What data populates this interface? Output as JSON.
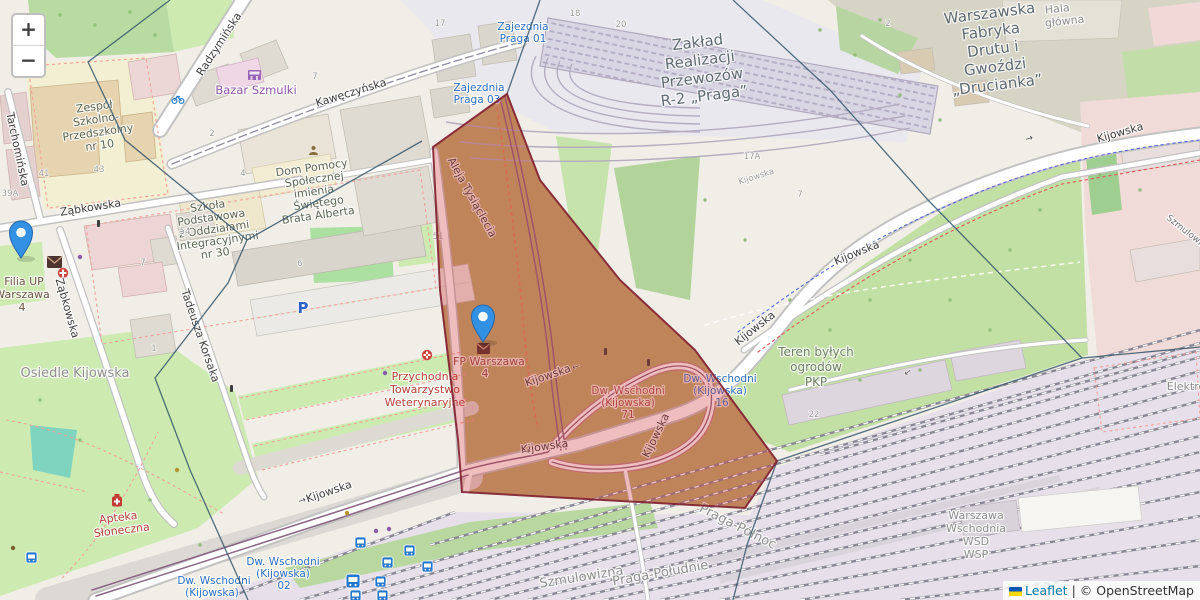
{
  "controls": {
    "zoom_in": "+",
    "zoom_out": "−"
  },
  "attribution": {
    "leaflet": "Leaflet",
    "sep": "|",
    "osm": "© OpenStreetMap"
  },
  "markers": {
    "left": {
      "lines": [
        "Filia UP",
        "Warszawa",
        "4"
      ]
    },
    "center": {
      "lines": [
        "FP Warszawa",
        "4"
      ]
    }
  },
  "streets": {
    "radzyminska": "Radzymińska",
    "kaweczynska": "Kawęczyńska",
    "tarchominska": "Tarchomińska",
    "zabkowska": "Ząbkowska",
    "korsaka": "Tadeusza Korsaka",
    "tysiaclecia": "Aleja Tysiąclecia",
    "kijowska": "Kijowska",
    "szmulowizna_st": "Szmulowizna",
    "oneway": "→"
  },
  "transit": {
    "zajezdnia01": {
      "lines": [
        "Zajezdnia",
        "Praga 01"
      ]
    },
    "zajezdnia03": {
      "lines": [
        "Zajezdnia",
        "Praga 03"
      ]
    },
    "dw71": {
      "lines": [
        "Dw. Wschodni",
        "(Kijowska)",
        "71"
      ]
    },
    "dw16": {
      "lines": [
        "Dw. Wschodni",
        "(Kijowska)",
        "16"
      ]
    },
    "dw02": {
      "lines": [
        "Dw. Wschodni",
        "(Kijowska)",
        "02"
      ]
    },
    "dw": {
      "lines": [
        "Dw. Wschodni",
        "(Kijowska)"
      ]
    }
  },
  "pois": {
    "bazar": "Bazar Szmulki",
    "zespol": {
      "lines": [
        "Zespół",
        "Szkolno-",
        "Przedszkolny",
        "nr 10"
      ]
    },
    "szkola": {
      "lines": [
        "Szkoła",
        "Podstawowa",
        "z Oddziałami",
        "Integracyjnymi",
        "nr 30"
      ]
    },
    "dom": {
      "lines": [
        "Dom Pomocy",
        "Społecznej",
        "imienia",
        "Świętego",
        "Brata Alberta"
      ]
    },
    "przychodnia": {
      "lines": [
        "Przychodnia",
        "Towarzystwo",
        "Weterynaryjne"
      ]
    },
    "apteka": {
      "lines": [
        "Apteka",
        "Słoneczna"
      ]
    },
    "zaklad": {
      "lines": [
        "Zakład",
        "Realizacji",
        "Przewozów",
        "R-2 „Praga”"
      ]
    },
    "fabryka": {
      "lines": [
        "Warszawska",
        "Fabryka",
        "Drutu i",
        "Gwoździ",
        "„Drucianka”"
      ]
    },
    "hala": {
      "lines": [
        "Hala",
        "główna"
      ]
    },
    "parking": "P"
  },
  "areas": {
    "osiedle": "Osiedle Kijowska",
    "teren": {
      "lines": [
        "Teren byłych",
        "ogrodów",
        "PKP"
      ]
    },
    "wschodnia": {
      "lines": [
        "Warszawa",
        "Wschodnia",
        "WSD",
        "WSP"
      ]
    },
    "szmulowizna": "Szmulowizna",
    "praga_pd": "Praga-Południe",
    "praga_pn": "Praga-Północ",
    "elektro": "Elektro"
  },
  "numbers": {
    "n17": "17",
    "n18": "18",
    "n20": "20",
    "n2": "2",
    "n54": "54",
    "n7": "7",
    "n6": "6",
    "n4": "4",
    "n1": "1",
    "n41": "41",
    "n43": "43",
    "n39a": "39A",
    "n51": "51",
    "n22": "22",
    "n17a": "17A",
    "kij": "Kijowska"
  }
}
